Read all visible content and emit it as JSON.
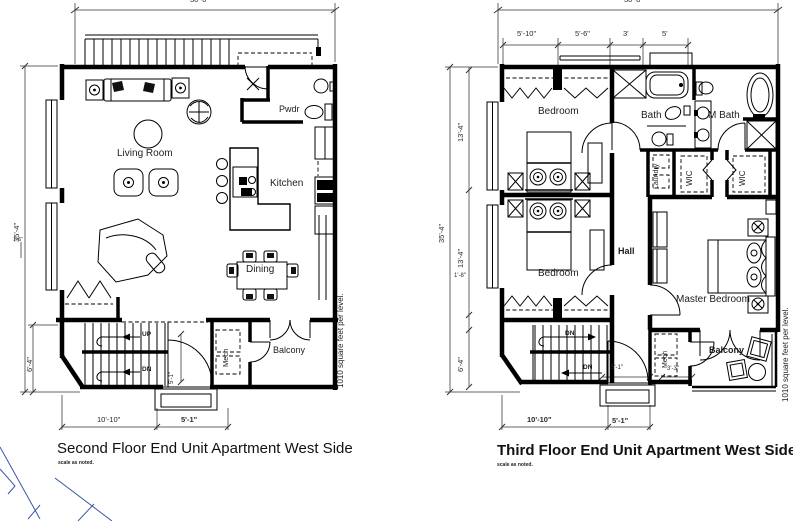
{
  "drawing": {
    "background": "#ffffff",
    "line_color": "#000000",
    "corner_accent_color": "#3a56a7"
  },
  "plans": {
    "second": {
      "title": "Second Floor End Unit Apartment West Side",
      "scale_note": "scale as noted.",
      "area_note": "1010 square feet per level.",
      "labels": {
        "living_room": "Living Room",
        "kitchen": "Kitchen",
        "dining": "Dining",
        "pwdr": "Pwdr",
        "mech": "Mech",
        "balcony": "Balcony",
        "stair_up": "UP",
        "stair_dn": "DN"
      },
      "dims": {
        "overall_width": "30'-0\"",
        "overall_height": "35'-4\"",
        "window_break": "1'-6\"",
        "stair_depth": "6'-4\"",
        "bottom_left": "10'-10\"",
        "bottom_entry": "5'-1\"",
        "entry_side": "5'-1\""
      }
    },
    "third": {
      "title": "Third Floor End Unit Apartment West Side",
      "scale_note": "scale as noted.",
      "area_note": "1010 square feet per level.",
      "labels": {
        "bedroom_a": "Bedroom",
        "bedroom_b": "Bedroom",
        "bath": "Bath",
        "m_bath": "M Bath",
        "laundry": "Laundry",
        "wic_a": "WIC",
        "wic_b": "WIC",
        "hall": "Hall",
        "master_bedroom": "Master Bedroom",
        "mech": "Mech",
        "balcony": "Balcony",
        "stair_dn_upper": "DN",
        "stair_dn_lower": "DN"
      },
      "dims": {
        "overall_width": "30'-8\"",
        "seg_1": "5'-10\"",
        "seg_2": "5'-6\"",
        "seg_3": "3'",
        "seg_4": "5'",
        "overall_height": "35'-4\"",
        "left_1": "13'-4\"",
        "left_2": "13'-4\"",
        "left_3": "1'-8\"",
        "left_4": "6'-4\"",
        "bottom_left": "10'-10\"",
        "bottom_entry": "5'-1\"",
        "porch_width": "5'-1\"",
        "mech_width": "3'-3\""
      }
    }
  }
}
